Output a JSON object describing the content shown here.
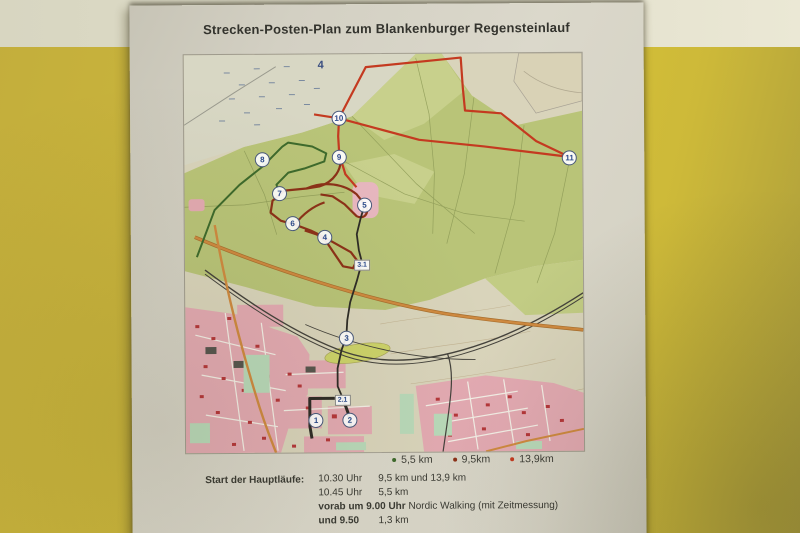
{
  "poster": {
    "title": "Strecken-Posten-Plan zum Blankenburger Regensteinlauf"
  },
  "legend": {
    "items": [
      {
        "label": "5,5 km",
        "color": "#3e6a2c"
      },
      {
        "label": "9,5km",
        "color": "#8c3118"
      },
      {
        "label": "13,9km",
        "color": "#c43a20"
      }
    ]
  },
  "schedule": {
    "heading": "Start der Hauptläufe:",
    "rows": [
      {
        "time": "10.30 Uhr",
        "distance": "9,5 km und 13,9 km"
      },
      {
        "time": "10.45 Uhr",
        "distance": "5,5 km"
      },
      {
        "time_bold": "vorab um 9.00 Uhr",
        "time_rest": " Nordic Walking (mit Zeitmessung)"
      },
      {
        "time_bold": "und 9.50",
        "distance": "1,3 km"
      }
    ]
  },
  "map": {
    "route_colors": {
      "long_13_9": "#c43a20",
      "medium_9_5": "#8c3118",
      "short_5_5": "#3e6a2c",
      "finish_leg": "#2e2c26"
    },
    "checkpoints": [
      {
        "label": "4",
        "kind": "plain",
        "x": 34.4,
        "y": 2.8
      },
      {
        "label": "10",
        "kind": "circle",
        "x": 38.9,
        "y": 16.1
      },
      {
        "label": "8",
        "kind": "circle",
        "x": 19.6,
        "y": 26.4
      },
      {
        "label": "9",
        "kind": "circle",
        "x": 38.9,
        "y": 25.9
      },
      {
        "label": "11",
        "kind": "circle",
        "x": 96.8,
        "y": 26.4
      },
      {
        "label": "7",
        "kind": "circle",
        "x": 23.9,
        "y": 34.9
      },
      {
        "label": "6",
        "kind": "circle",
        "x": 27.1,
        "y": 42.5
      },
      {
        "label": "5",
        "kind": "circle",
        "x": 45.2,
        "y": 37.9
      },
      {
        "label": "4",
        "kind": "circle",
        "x": 35.2,
        "y": 46.0
      },
      {
        "label": "3.1",
        "kind": "box",
        "x": 44.5,
        "y": 53.0
      },
      {
        "label": "3",
        "kind": "circle",
        "x": 40.5,
        "y": 71.4
      },
      {
        "label": "2.1",
        "kind": "box",
        "x": 39.4,
        "y": 86.9
      },
      {
        "label": "1",
        "kind": "circle",
        "x": 32.7,
        "y": 92.0
      },
      {
        "label": "2",
        "kind": "circle",
        "x": 41.2,
        "y": 92.0
      }
    ]
  }
}
